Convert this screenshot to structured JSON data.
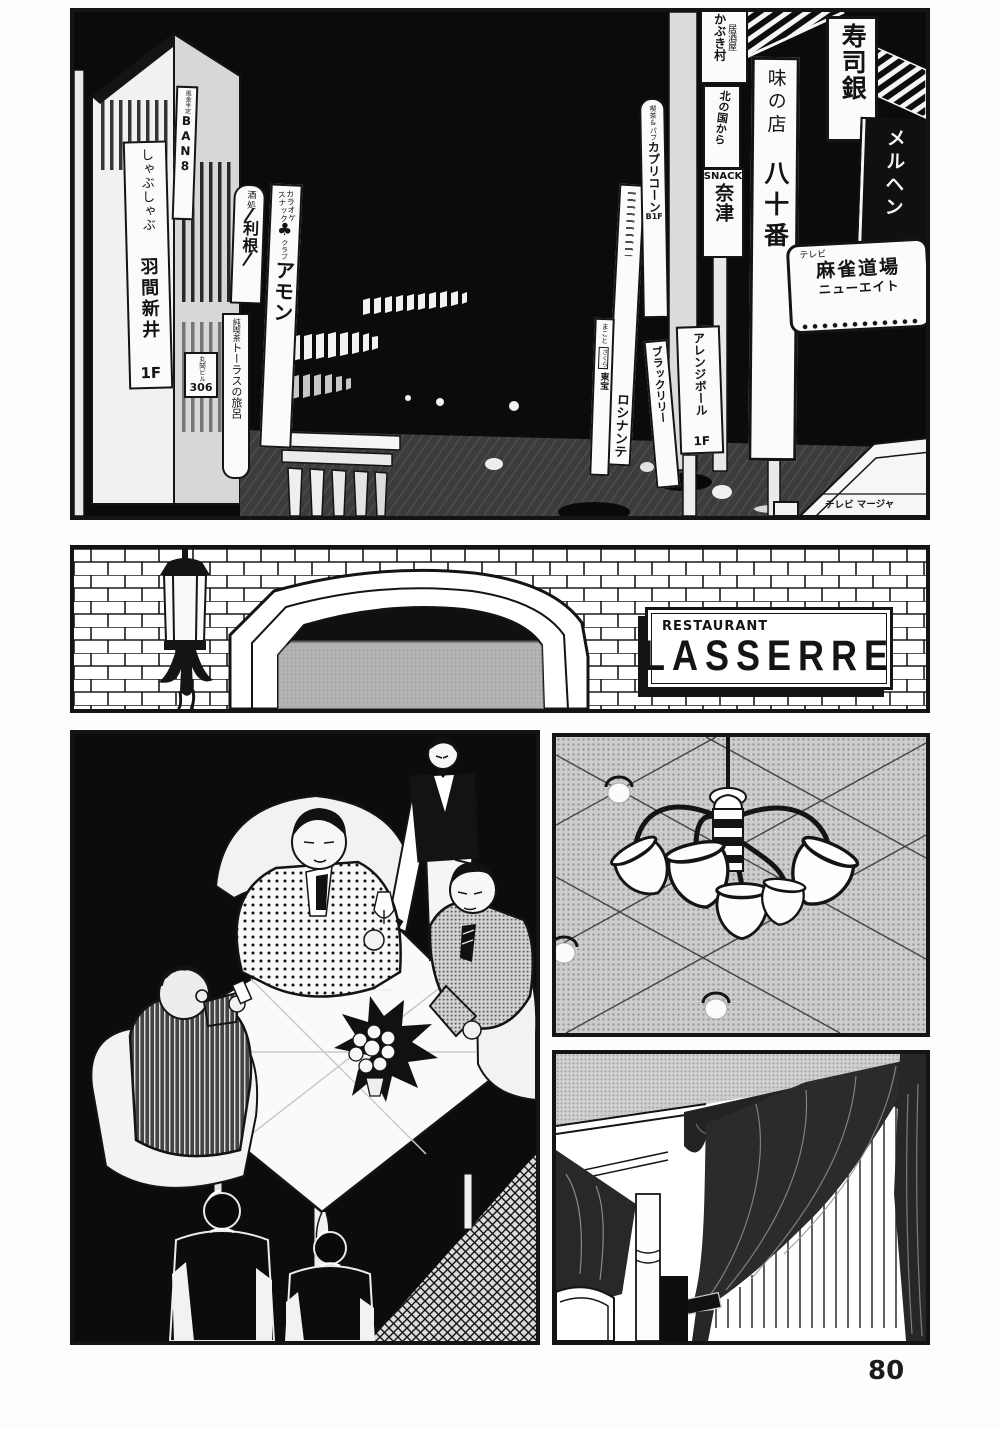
{
  "page_number": "80",
  "colors": {
    "ink": "#141414",
    "paper": "#ffffff",
    "night_sky": "#0b0b0b",
    "street": "#3f3f3f",
    "halftone": "#cdcdcd"
  },
  "street_panel": {
    "signs": {
      "ban8": {
        "small": "風金半定",
        "main": "BAN8"
      },
      "shabu": {
        "kana": "しゃぶしゃぶ",
        "name": "羽間新井",
        "floor": "1F"
      },
      "tone": {
        "small": "酒処",
        "name": "利根"
      },
      "amon": {
        "line1": "カラオケ",
        "line2": "スナック",
        "club_icon": "♣",
        "small": "クラブ",
        "name": "アモン"
      },
      "bldg306": {
        "name": "丸岡ビル",
        "number": "306"
      },
      "taurus": {
        "small": "純喫茶",
        "name": "トーラスの旅呂"
      },
      "kabuki": {
        "small": "居酒屋",
        "name": "かぶき村"
      },
      "kitanokuni": {
        "name": "北の国から"
      },
      "natsu": {
        "small": "SNACK",
        "name": "奈津"
      },
      "capricorn": {
        "small": "喫茶&パブ",
        "name": "カプリコーン",
        "floor": "B1F"
      },
      "makoto": {
        "top": "まこと",
        "mid": "さくら",
        "bottom": "東宝"
      },
      "rocinante": {
        "name": "ロシナンテ"
      },
      "blacklily": {
        "name": "ブラックリリー"
      },
      "arrangeball": {
        "name": "アレンジボール",
        "floor": "1F"
      },
      "ajinomise": {
        "line1": "味の店",
        "line2": "八十番"
      },
      "sushigin": {
        "name": "寿司銀"
      },
      "marchen": {
        "name": "メルヘン"
      },
      "mahjong": {
        "small": "テレビ",
        "main": "麻雀道場",
        "sub": "ニューエイト"
      },
      "awning": {
        "text": "テレビ マージャ"
      }
    }
  },
  "restaurant_panel": {
    "sign": {
      "top": "RESTAURANT",
      "name": "LASSERRE"
    }
  }
}
